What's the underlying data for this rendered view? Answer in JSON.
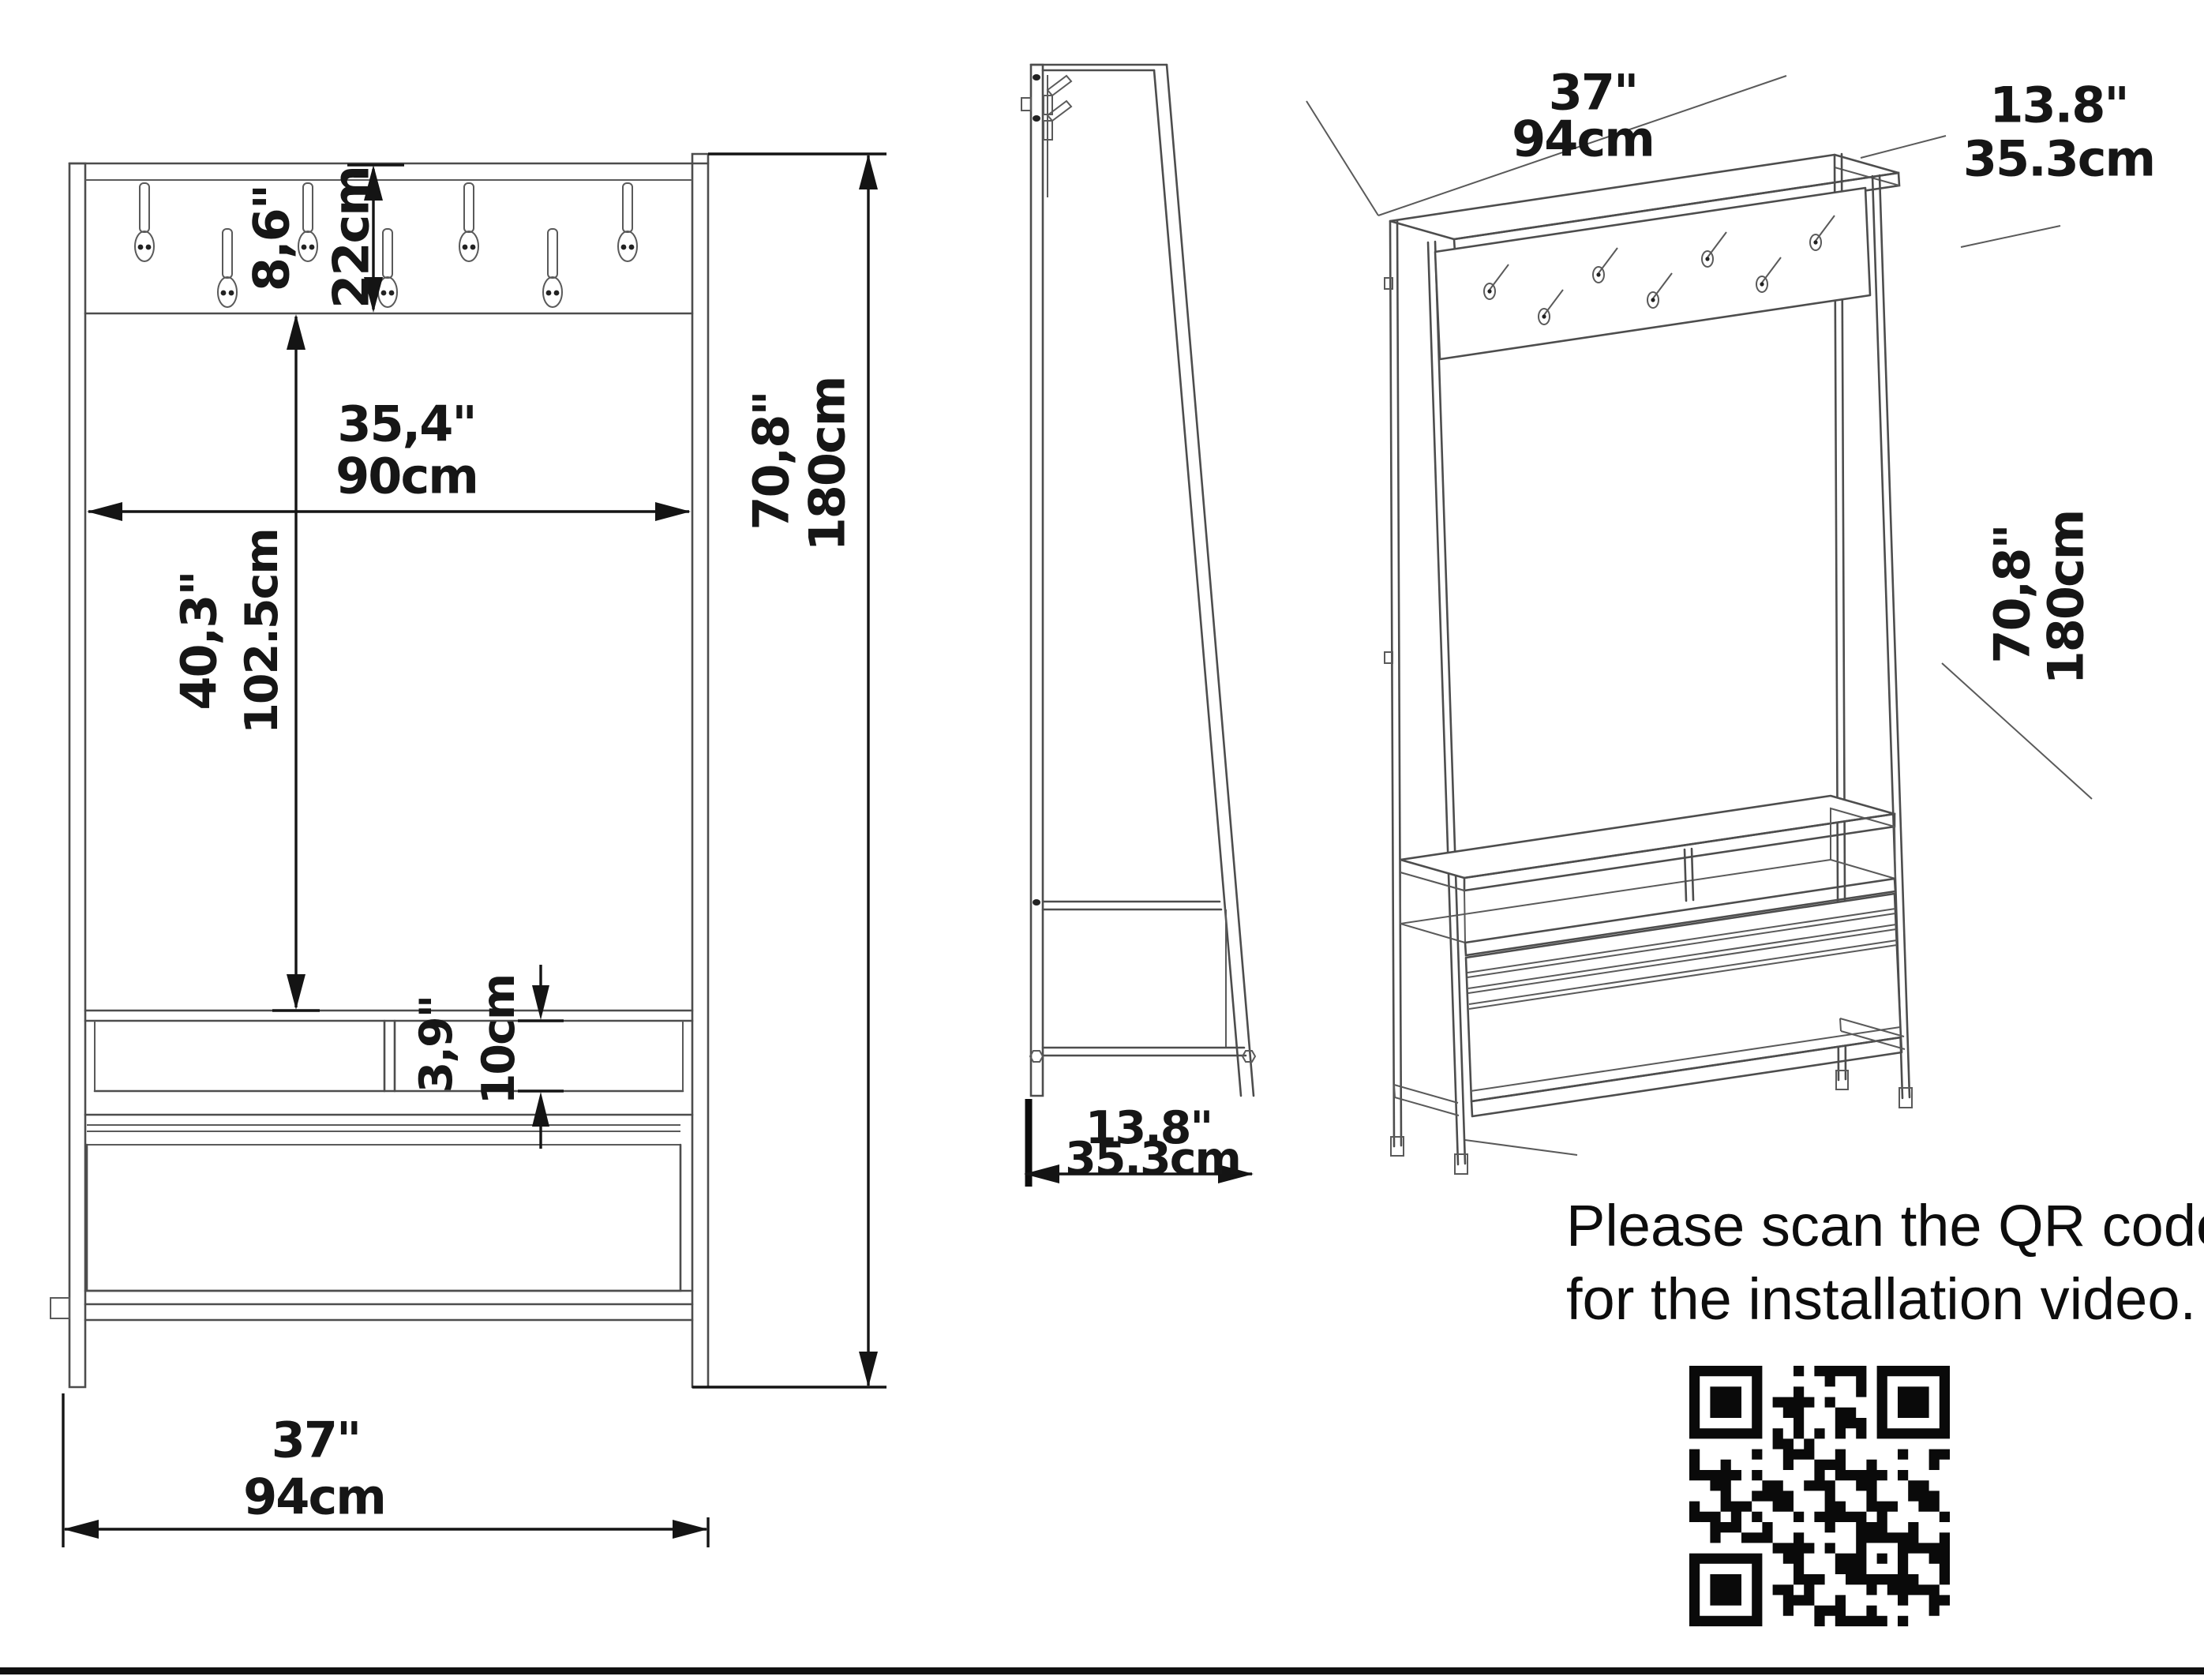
{
  "front": {
    "hook_board": {
      "in": "8,6\"",
      "cm": "22cm"
    },
    "inner_width": {
      "in": "35,4\"",
      "cm": "90cm"
    },
    "open_height": {
      "in": "40,3\"",
      "cm": "102.5cm"
    },
    "shelf_gap": {
      "in": "3,9\"",
      "cm": "10cm"
    },
    "width": {
      "in": "37\"",
      "cm": "94cm"
    },
    "height": {
      "in": "70,8\"",
      "cm": "180cm"
    }
  },
  "side": {
    "depth": {
      "in": "13.8\"",
      "cm": "35.3cm"
    }
  },
  "iso": {
    "width": {
      "in": "37\"",
      "cm": "94cm"
    },
    "depth": {
      "in": "13.8\"",
      "cm": "35.3cm"
    },
    "height": {
      "in": "70,8\"",
      "cm": "180cm"
    }
  },
  "note": {
    "line1": "Please scan the QR code",
    "line2": "for the installation video."
  },
  "meta": {
    "hook_count_front": 7,
    "views": 3
  }
}
